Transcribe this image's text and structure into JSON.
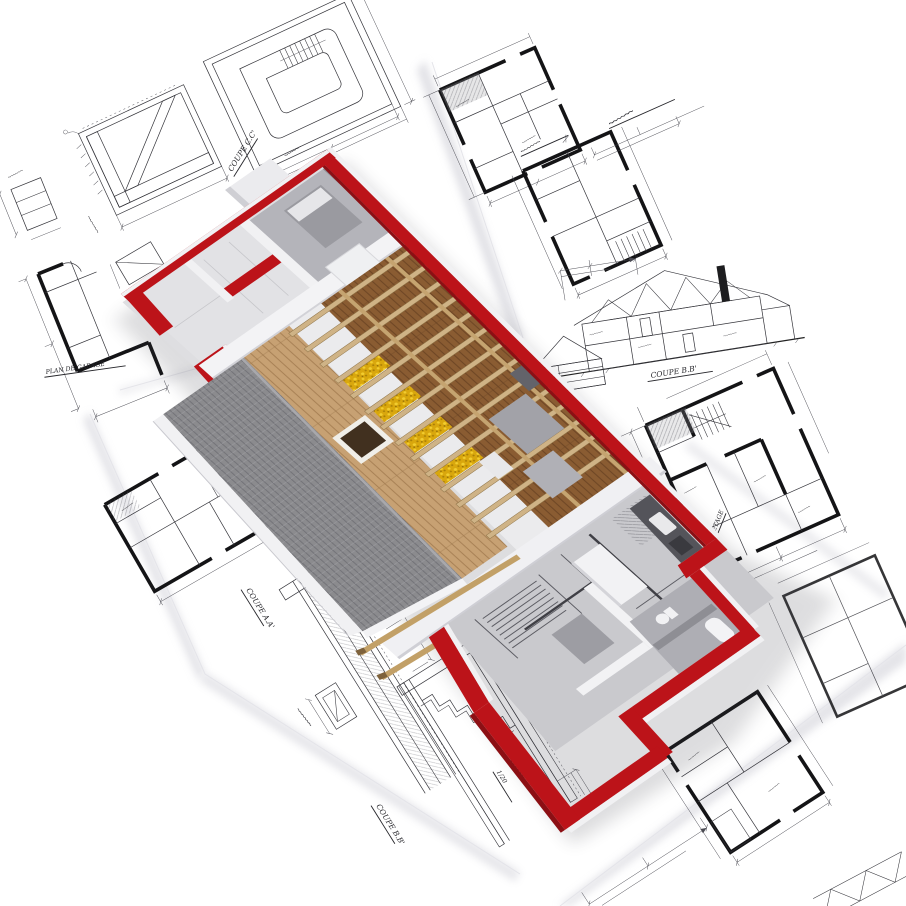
{
  "scene": {
    "type": "3d-architectural-render",
    "description": "Isometric 3D cutaway model of a house under construction standing on a pile of scattered architectural blueprint sheets",
    "house": {
      "walls": "red painted masonry, partially built, white capped",
      "roof": "gray shingled slope partially covered, tan wood sheathing with skylight opening",
      "floors": "wooden plank attic floor with exposed joists",
      "insulation": "yellow mineral wool laid between joists",
      "interior": "bed, furniture, kitchen counter and bathroom fittings; unfinished rooms show the printed floor plan on the slab"
    },
    "blueprints": "floor plans, stair tower plan, framing details, wall sections and roof truss elevations with dimension lines and handwritten labels"
  },
  "labels": {
    "coupe_aa": "COUPE A.A'",
    "coupe_bb_section": "COUPE B.B'",
    "coupe_bb_detail": "COUPE B.B'",
    "coupe_cc": "COUPE C.C'",
    "plan_garage": "PLAN DE GARAGE",
    "etage": "1° ETAGE",
    "echelle": "1/20"
  },
  "palette": {
    "background": "#ffffff",
    "paper_shadow": "#c9c9d2",
    "blueprint_line": "#34343a",
    "wall_red": "#bc1319",
    "wall_red_dark": "#8c0f14",
    "roof_gray": "#8b8b8e",
    "wood_floor": "#8a5c32",
    "wood_sheathing": "#c7a173",
    "joist": "#cfb386",
    "insulation_yellow": "#d9a70d",
    "wall_white": "#f2f2f4",
    "interior_gray": "#c9c9cd"
  }
}
